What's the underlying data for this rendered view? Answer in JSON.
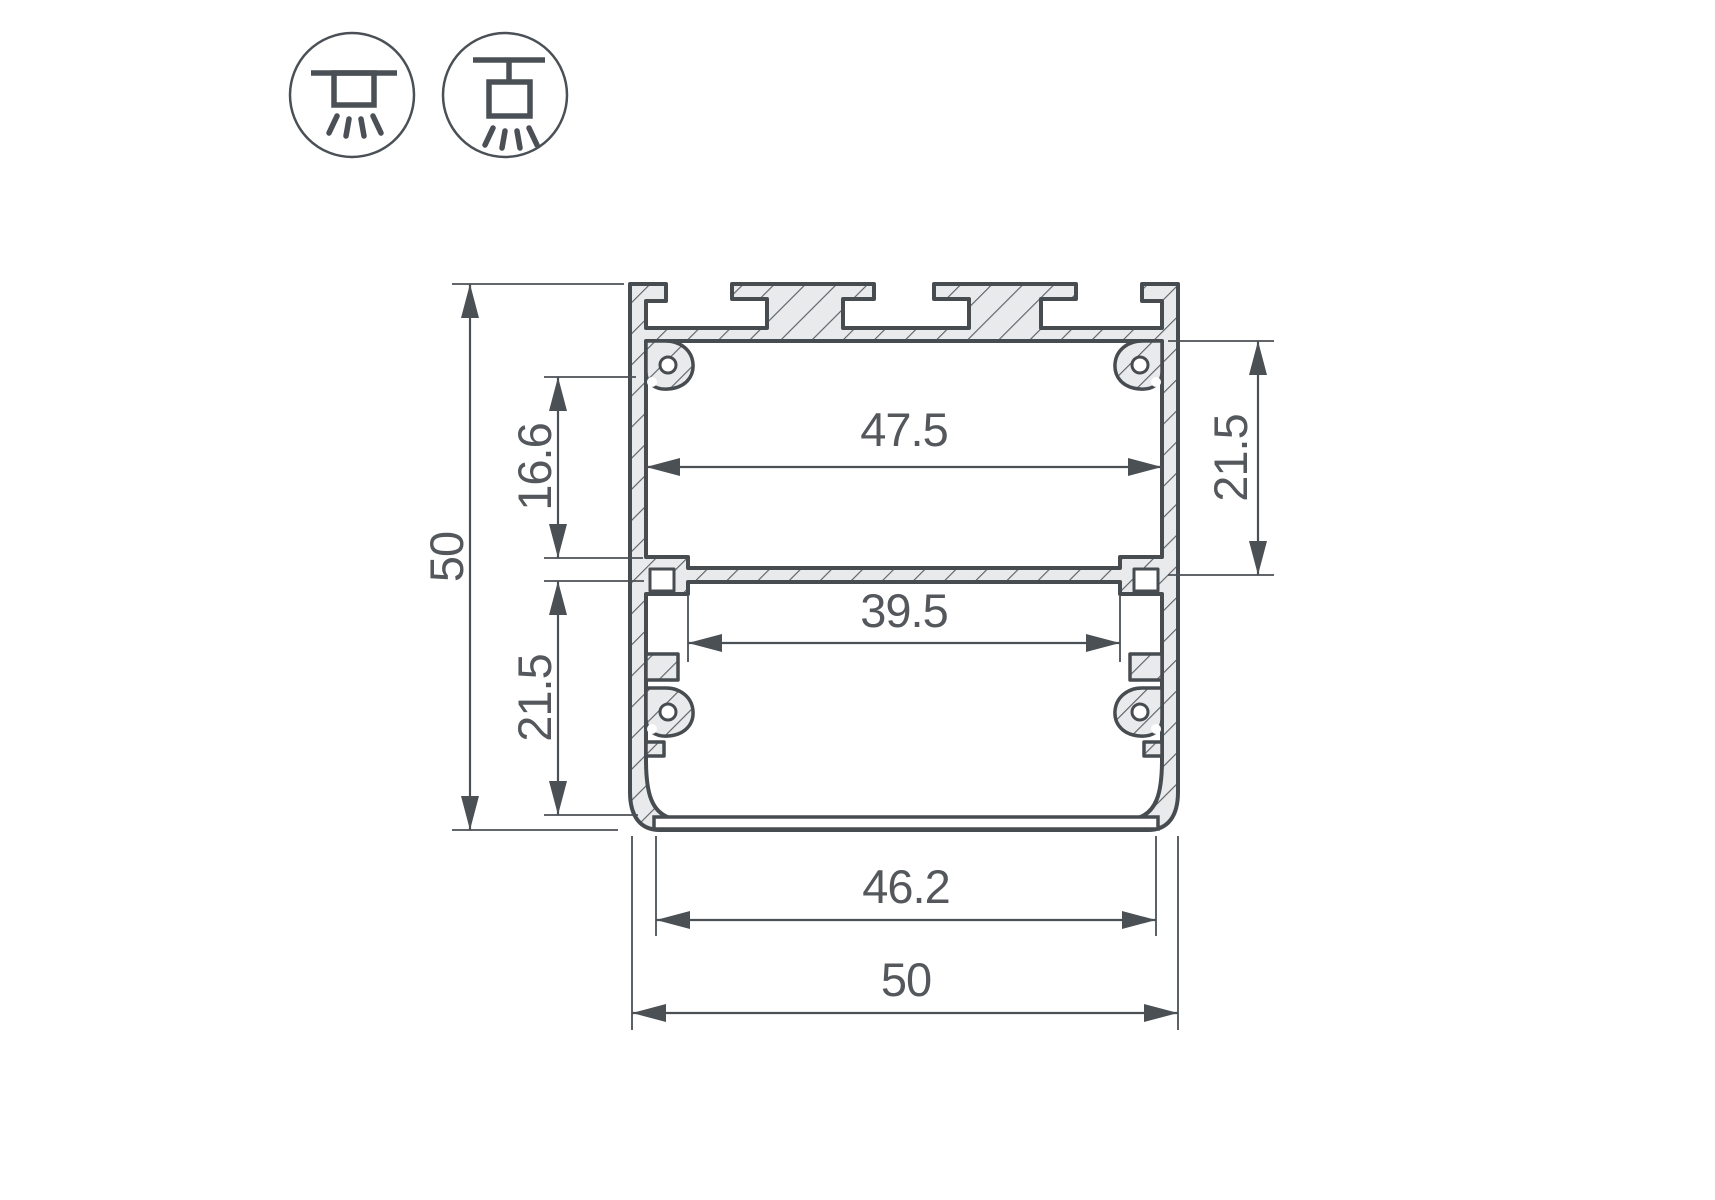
{
  "drawing": {
    "title": "led-profile-cross-section",
    "dimensions": {
      "overall_height": {
        "value": "50"
      },
      "upper_inner_height": {
        "value": "16.6"
      },
      "lower_inner_height_left": {
        "value": "21.5"
      },
      "inner_width_top": {
        "value": "47.5"
      },
      "inner_height_right": {
        "value": "21.5"
      },
      "inner_width_mid": {
        "value": "39.5"
      },
      "opening_width_bottom": {
        "value": "46.2"
      },
      "overall_width": {
        "value": "50"
      }
    },
    "colors": {
      "line": "#474c51",
      "dimension_line": "#4b5055",
      "text": "#54585c",
      "metal_fill": "#e9eaeb",
      "background": "#ffffff"
    },
    "icons": [
      {
        "name": "surface-mount-icon"
      },
      {
        "name": "pendant-mount-icon"
      }
    ]
  }
}
